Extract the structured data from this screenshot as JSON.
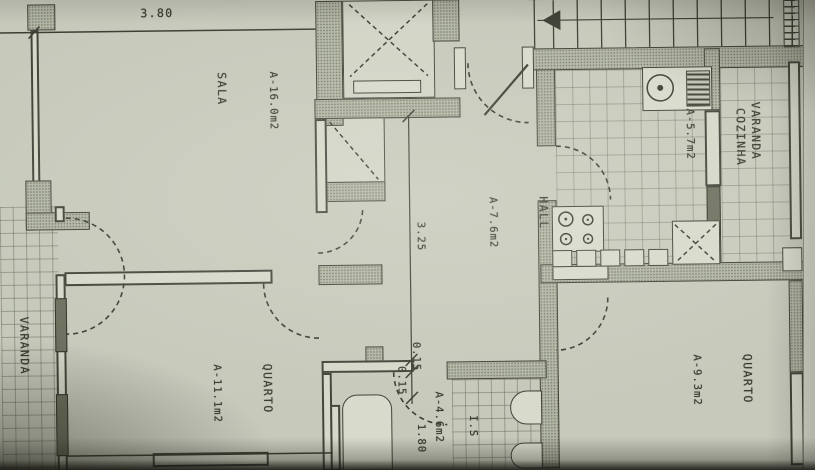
{
  "document": {
    "kind": "apartment floor plan (scanned drawing)"
  },
  "rooms": {
    "sala": {
      "name": "SALA",
      "area": "A-16.0m2"
    },
    "hall": {
      "name": "HALL",
      "area": "A-7.6m2"
    },
    "cozinha": {
      "name": "COZINHA",
      "area": "A-5.7m2"
    },
    "varanda_left": {
      "name": "VARANDA"
    },
    "varanda_right": {
      "name": "VARANDA"
    },
    "quarto_left": {
      "name": "QUARTO",
      "area": "A-11.1m2"
    },
    "quarto_right": {
      "name": "QUARTO",
      "area": "A-9.3m2"
    },
    "is": {
      "name": "I.S",
      "area": "A-4.6m2"
    }
  },
  "dimensions": {
    "sala_width": "3.80",
    "hall_length": "3.25",
    "wall_a": "0.15",
    "wall_b": "0.15",
    "is_width": "1.80"
  },
  "colors": {
    "paper": "#c7cabb",
    "ink": "#3c3e33",
    "wall_fill": "#b2b6a4"
  }
}
